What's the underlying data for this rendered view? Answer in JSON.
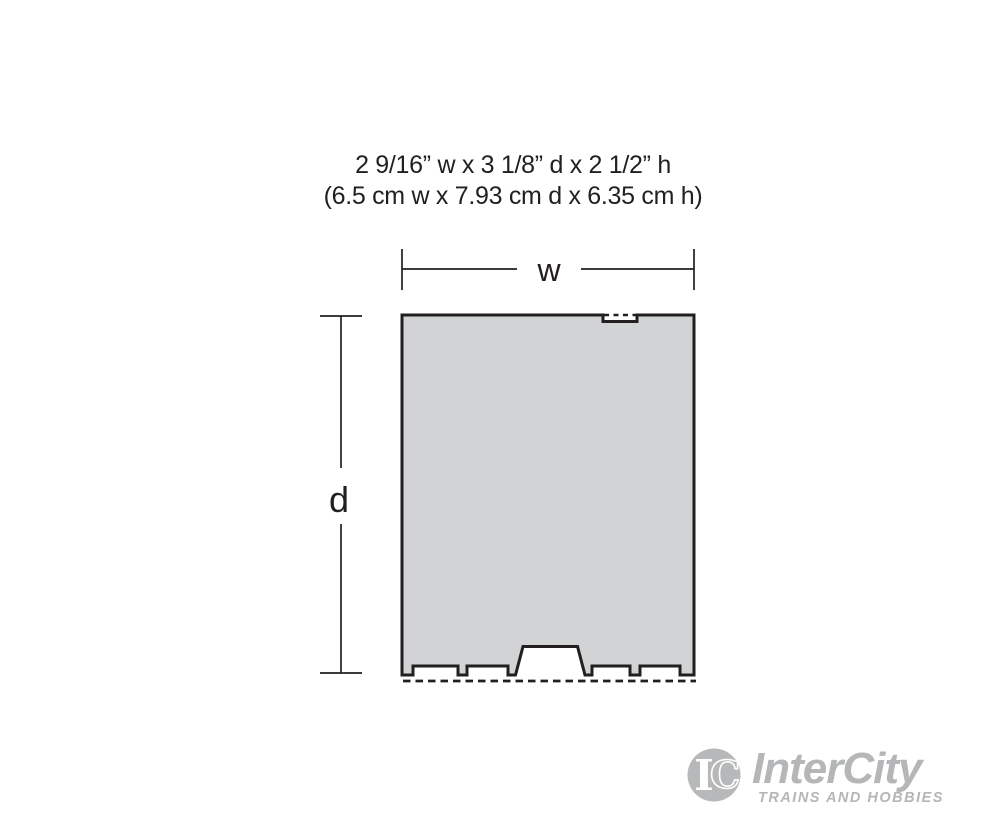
{
  "header": {
    "line1": "2 9/16” w x 3 1/8” d x 2 1/2” h",
    "line2": "(6.5 cm w x 7.93 cm d x 6.35 cm h)"
  },
  "diagram": {
    "width_label": "w",
    "depth_label": "d",
    "footprint_fill": "#d1d3d4",
    "outline_color": "#231f20"
  },
  "logo": {
    "monogram_i": "I",
    "monogram_c": "C",
    "brand": "InterCity",
    "tagline": "TRAINS AND HOBBIES",
    "color": "#b4b6b8"
  }
}
